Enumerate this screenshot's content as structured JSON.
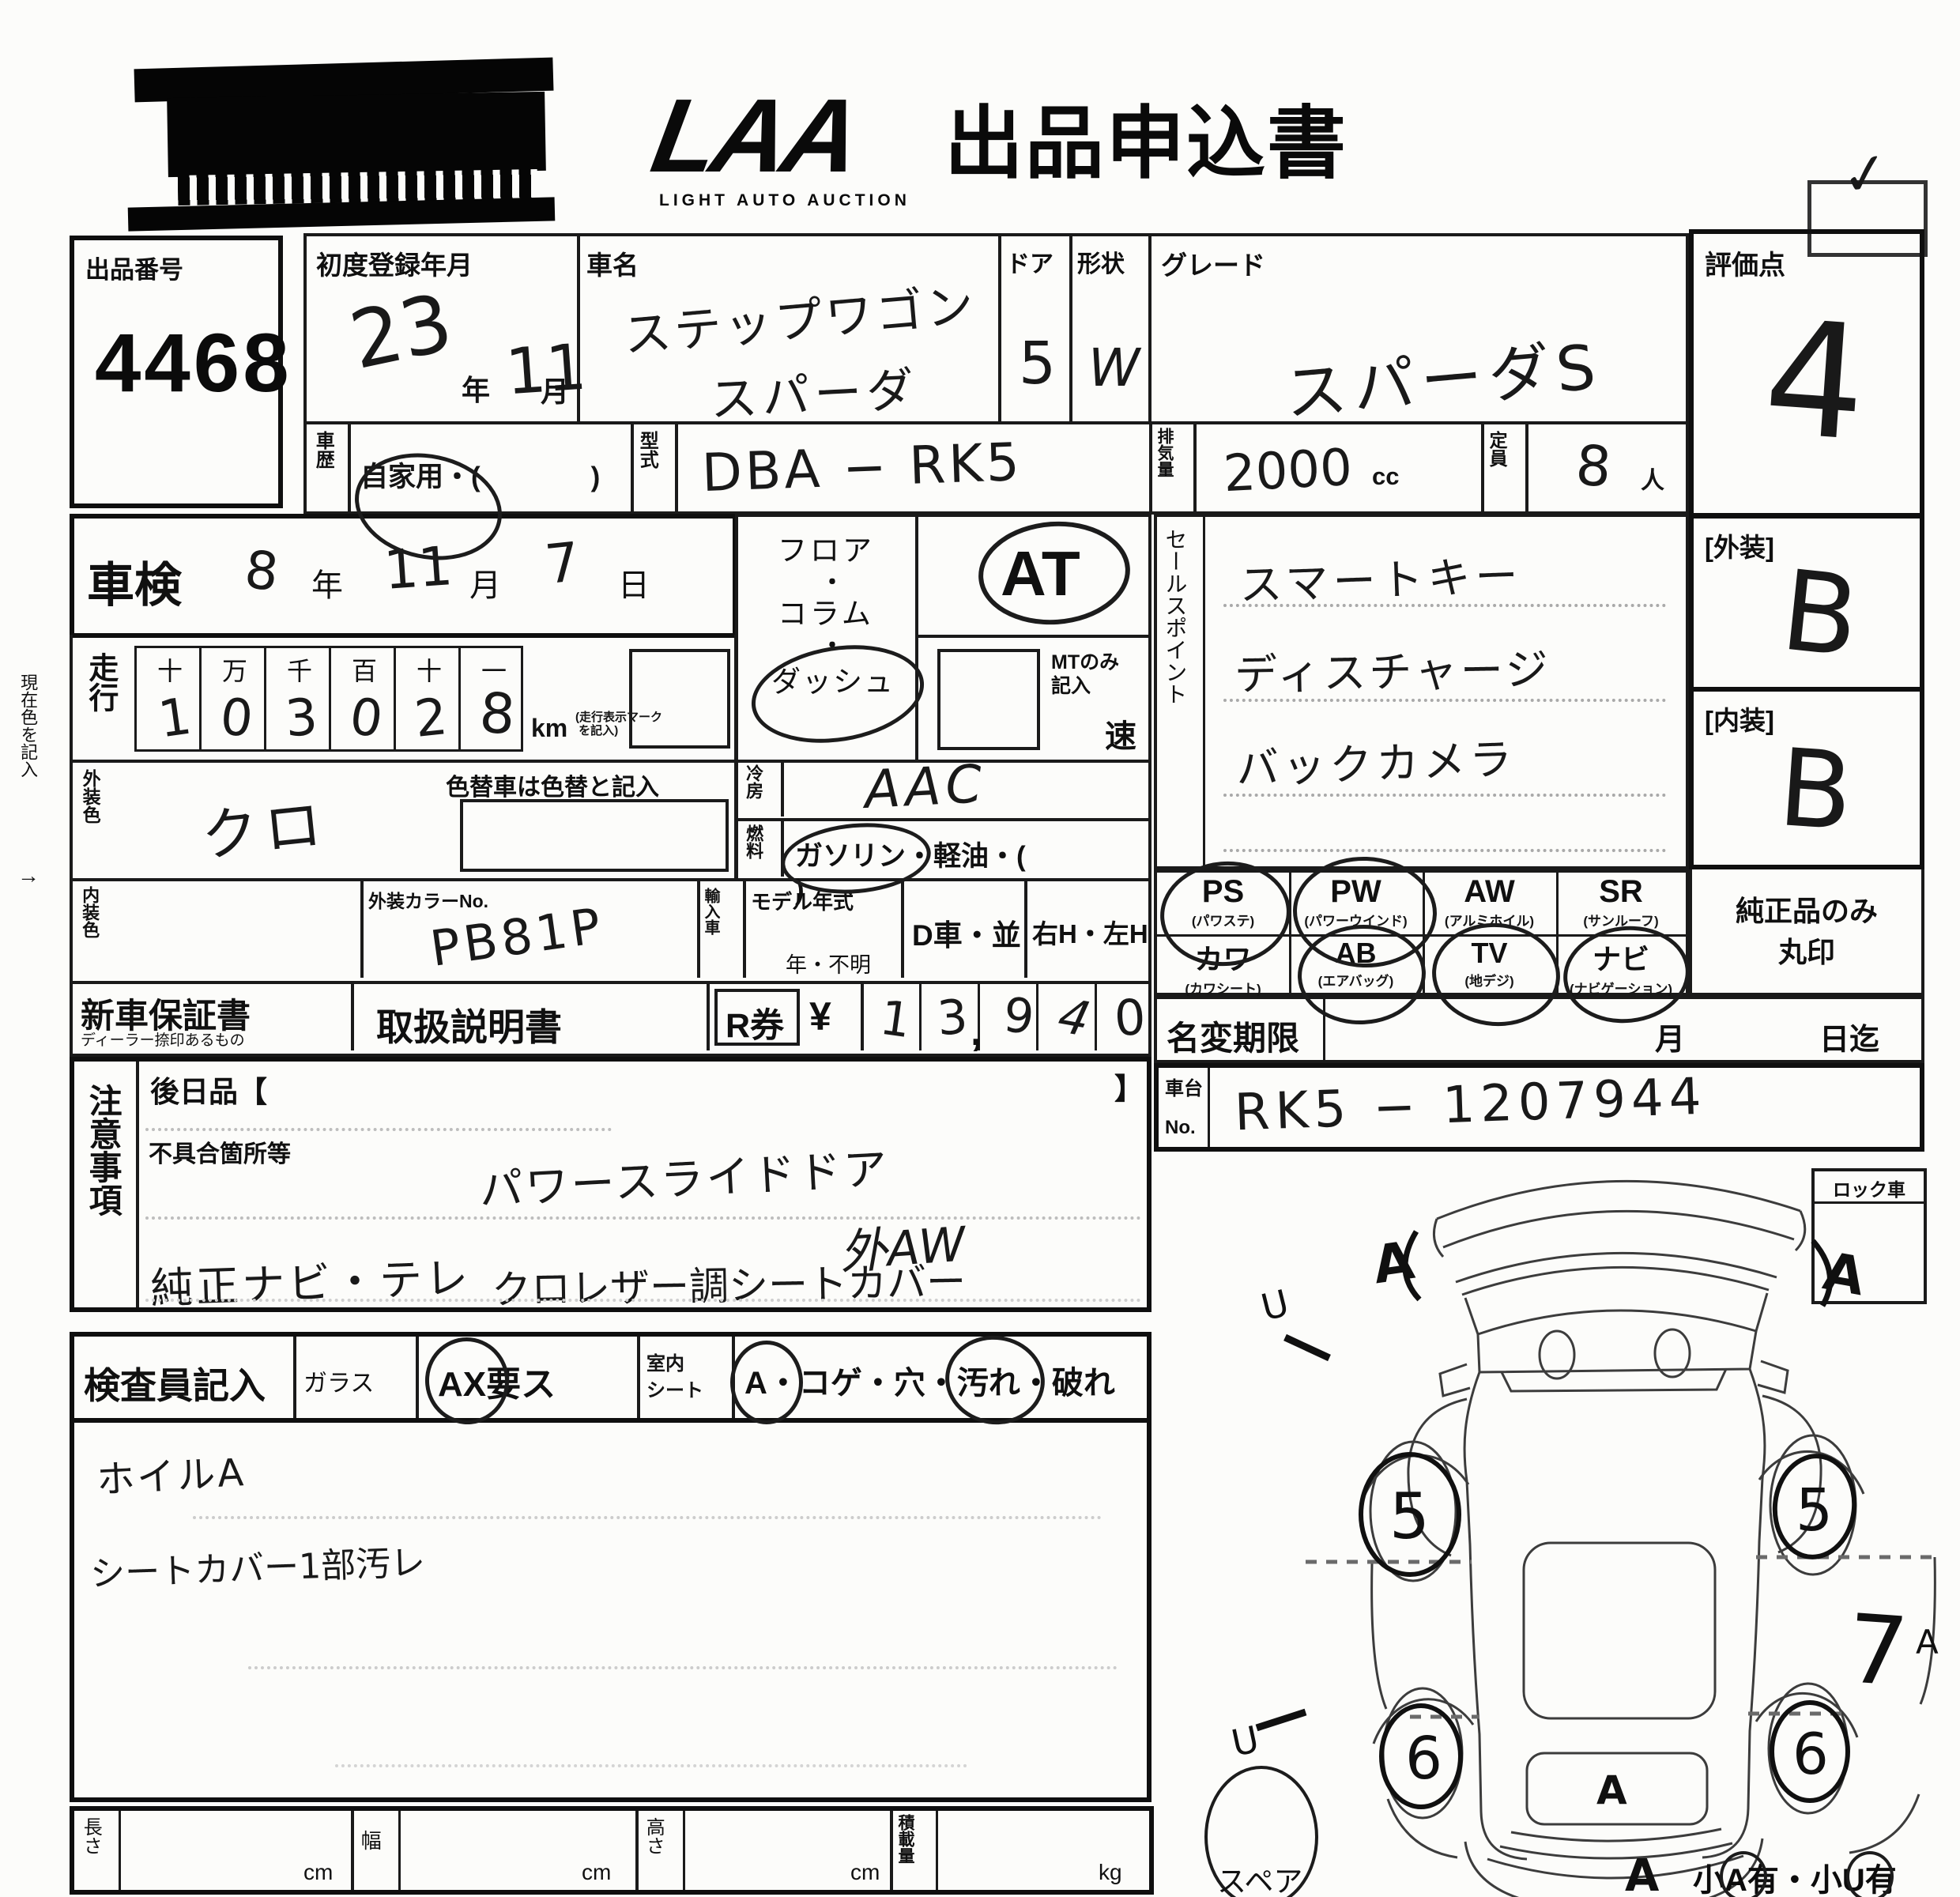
{
  "header": {
    "logo": "LAA",
    "logo_sub": "LIGHT AUTO AUCTION",
    "title": "出品申込書",
    "check": "✓"
  },
  "lot": {
    "label": "出品番号",
    "value": "4468"
  },
  "registration": {
    "label": "初度登録年月",
    "year": "23",
    "year_unit": "年",
    "month": "11",
    "month_unit": "月"
  },
  "car_name": {
    "label": "車名",
    "line1": "ステップワゴン",
    "line2": "スパーダ"
  },
  "doors": {
    "label": "ドア",
    "value": "5"
  },
  "shape": {
    "label": "形状",
    "value": "W"
  },
  "grade": {
    "label": "グレード",
    "value": "スパーダS"
  },
  "score": {
    "label": "評価点",
    "value": "4"
  },
  "history": {
    "label": "車歴",
    "value": "自家用・(　　　　)"
  },
  "model_code": {
    "label": "型式",
    "value": "DBA − RK5"
  },
  "displacement": {
    "label": "排気量",
    "value": "2000",
    "unit": "cc"
  },
  "capacity": {
    "label": "定員",
    "value": "8",
    "unit": "人"
  },
  "shaken": {
    "label": "車検",
    "year": "8",
    "year_unit": "年",
    "month": "11",
    "month_unit": "月",
    "day": "7",
    "day_unit": "日"
  },
  "mileage": {
    "label": "走行",
    "headers": [
      "十",
      "万",
      "千",
      "百",
      "十",
      "一"
    ],
    "digits": [
      "1",
      "0",
      "3",
      "0",
      "2",
      "8"
    ],
    "unit": "km",
    "note1": "走行表示マーク",
    "note2": "を記入"
  },
  "drive": {
    "floor": "フロア",
    "sep1": "・",
    "column": "コラム",
    "sep2": "・",
    "dash": "ダッシュ",
    "at": "AT",
    "mt_note1": "MTのみ",
    "mt_note2": "記入",
    "speed": "速"
  },
  "cooling": {
    "label": "冷房",
    "value": "AAC"
  },
  "fuel": {
    "label": "燃料",
    "gas": "ガソリン",
    "rest": "・軽油・(",
    "close": ")"
  },
  "ext_color": {
    "label": "外装色",
    "value": "クロ",
    "note": "色替車は色替と記入"
  },
  "int_color": {
    "label": "内装色",
    "color_no_label": "外装カラーNo.",
    "color_no": "PB81P",
    "import_label": "輸入車",
    "model_year_label": "モデル年式",
    "model_year_suffix": "年・不明",
    "d_car": "D車・並",
    "handle": "右H・左H"
  },
  "warranty": {
    "label": "新車保証書",
    "sub": "ディーラー捺印あるもの"
  },
  "manual": {
    "label": "取扱説明書"
  },
  "r_ticket": {
    "label": "R券",
    "yen": "¥",
    "digits": [
      "1",
      "3",
      "9",
      "4",
      "0"
    ],
    "comma": ","
  },
  "sales_point": {
    "label": "セールスポイント",
    "items": [
      "スマートキー",
      "ディスチャージ",
      "バックカメラ"
    ]
  },
  "exterior": {
    "label": "[外装]",
    "value": "B"
  },
  "interior": {
    "label": "[内装]",
    "value": "B"
  },
  "genuine": {
    "line1": "純正品のみ",
    "line2": "丸印"
  },
  "equipment": {
    "r1": [
      {
        "code": "PS",
        "name": "(パワステ)"
      },
      {
        "code": "PW",
        "name": "(パワーウインド)"
      },
      {
        "code": "AW",
        "name": "(アルミホイル)"
      },
      {
        "code": "SR",
        "name": "(サンルーフ)"
      }
    ],
    "r2": [
      {
        "code": "カワ",
        "name": "(カワシート)"
      },
      {
        "code": "AB",
        "name": "(エアバッグ)"
      },
      {
        "code": "TV",
        "name": "(地デジ)"
      },
      {
        "code": "ナビ",
        "name": "(ナビゲーション)"
      }
    ]
  },
  "name_change": {
    "label": "名変期限",
    "month": "月",
    "day": "日迄"
  },
  "chassis": {
    "label_1": "車台",
    "label_2": "No.",
    "value": "RK5 − 1207944"
  },
  "notes": {
    "label": "注意事項",
    "later": "後日品【",
    "bracket": "】",
    "defect_label": "不具合箇所等",
    "line1": "パワースライドドア",
    "line2": "外AW",
    "line3": "純正ナビ・テレ",
    "line4": "クロレザー調シートカバー"
  },
  "inspector": {
    "label": "検査員記入",
    "glass_label": "ガラス",
    "glass_a": "A",
    "glass_rest": "X要ス",
    "seat_label_1": "室内",
    "seat_label_2": "シート",
    "seat_a": "A",
    "seat_mid": "・コゲ・穴・",
    "seat_stain": "汚れ",
    "seat_end": "・破れ",
    "note1": "ホイルA",
    "note2": "シートカバー1部汚レ"
  },
  "lock": {
    "label": "ロック車"
  },
  "diagram": {
    "front_left_wheel": "5",
    "front_right_wheel": "5",
    "rear_left_wheel": "6",
    "rear_right_wheel": "6",
    "front_left_mark": "A",
    "front_right_mark": "A",
    "right_side_mark": "7",
    "right_side_mark2": "A",
    "rear_mark": "A",
    "rear_bottom_mark": "A",
    "u_mark1": "U",
    "u_mark2": "U",
    "spare_label": "スペア",
    "small_1": "小",
    "small_a": "A",
    "small_2": "有・小",
    "small_u": "U",
    "small_3": "有"
  },
  "dims": {
    "length": "長さ",
    "width": "幅",
    "height": "高さ",
    "load": "積載量",
    "cm": "cm",
    "kg": "kg"
  },
  "side_note": {
    "text": "現在色を記入",
    "arrow": "→"
  }
}
